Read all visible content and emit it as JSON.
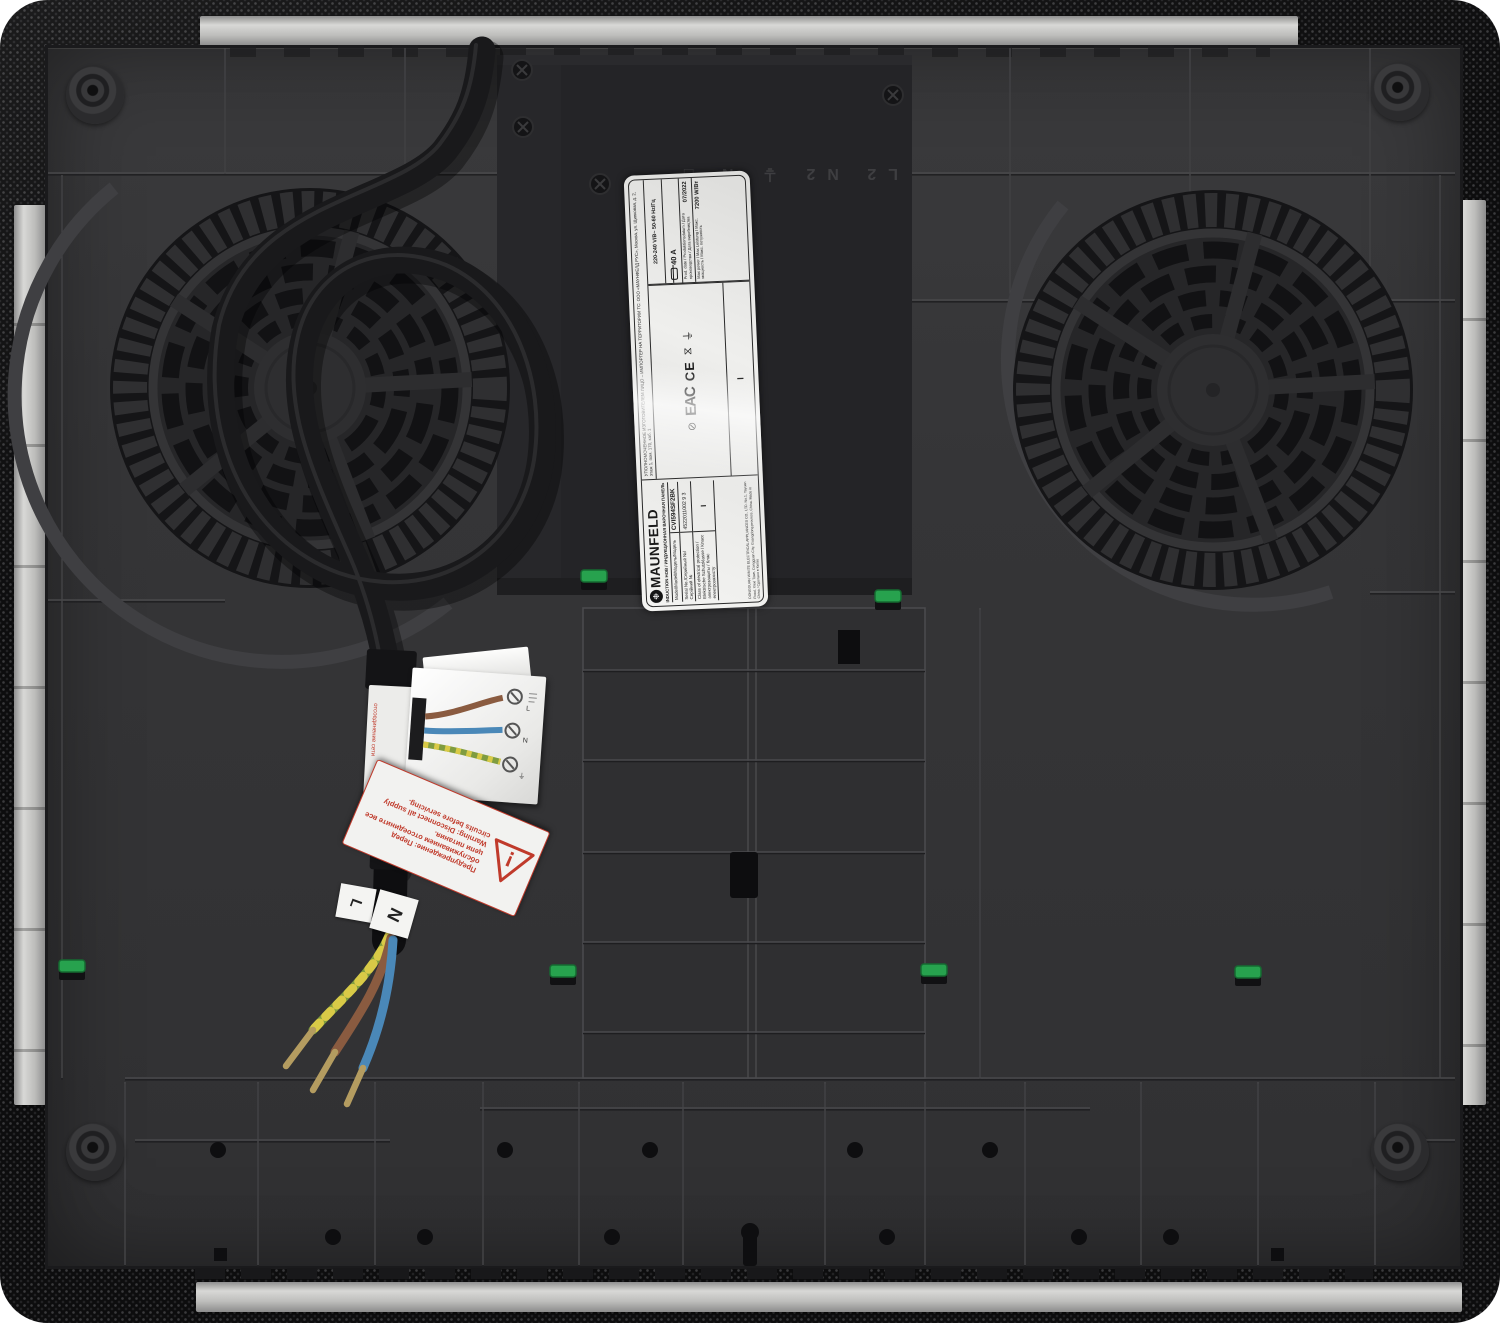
{
  "label": {
    "brand": "MAUNFELD",
    "logo_glyph": "❉",
    "product_type": "INDUCTION HOB / ИНДУКЦИОННАЯ ВАРОЧНАЯ ПАНЕЛЬ",
    "model_key": "Model/Modell/Модель/Модель",
    "model_value": "CVI594SF2BK",
    "serial_key": "Serial No./Серийный №/Серійний №",
    "serial_value": "4522011002 9 3",
    "class_key": "Class of electrical protection / Elektrische Schutzklasse / Класс электрозащиты / Клас електрозахисту",
    "class_value": "I",
    "importer": "УПОЛНОМОЧЕННОЕ ИЗГОТОВИТЕЛЕМ ЛИЦО – ИМПОРТЕР НА ТЕРРИТОРИИ ТС: ООО «МАУНФЕЛД РУС», Москва, ул. Щипковая, д. 2, этаж 1, пом. 170, каб. 1",
    "manufacturer": "DONGGUAN WINITE ELECTRICAL APPLIANCES CO., LTD. No.1, Yayuan Road, Xiexi Town, Dongguan City, Guangdong province, China. Made in China / Сделано в Китае",
    "marks": {
      "eac": "EAC",
      "ce": "CE",
      "sym1": "⊘",
      "sym2": "⧖",
      "sym3": "⏚"
    },
    "specs": {
      "voltage": "220-240 V/B~ 50-60 Hz/Гц",
      "current": "40 A",
      "prod_date_key": "Prod. date / Produktionsdatum / Дата производства / Дата виробництва",
      "prod_date_value": "07/2022",
      "max_power_key": "Max power / Max Leistung / Макс. мощность / Макс. потужність",
      "max_power_value": "7200 W/Вт"
    }
  },
  "embossed": {
    "markings": "L2 N2 ⏚ N □"
  },
  "wire_flags": {
    "live": "L",
    "neutral": "N"
  },
  "wiring_sticker": {
    "live": "L",
    "neutral": "N",
    "earth": "⏚",
    "note": "отсоединение сети"
  },
  "warning_sticker": {
    "symbol": "!",
    "ru": "Предупреждение: Перед обслуживанием отсоедините все цепи питания.",
    "en": "Warning: Disconnect all supply circuits before servicing."
  },
  "colors": {
    "glass": "#0d0d0e",
    "pan": "#343436",
    "rail_silver": "#c9c9c7",
    "clip_green": "#27a24e",
    "label_bg": "#e9e9e7",
    "warning_red": "#c03a2b",
    "wire_brown": "#8a5b40",
    "wire_blue": "#4a88b8",
    "wire_earth_green": "#7f9c3f",
    "wire_earth_yellow": "#d9ca47",
    "ferrule_brass": "#b49c60"
  }
}
